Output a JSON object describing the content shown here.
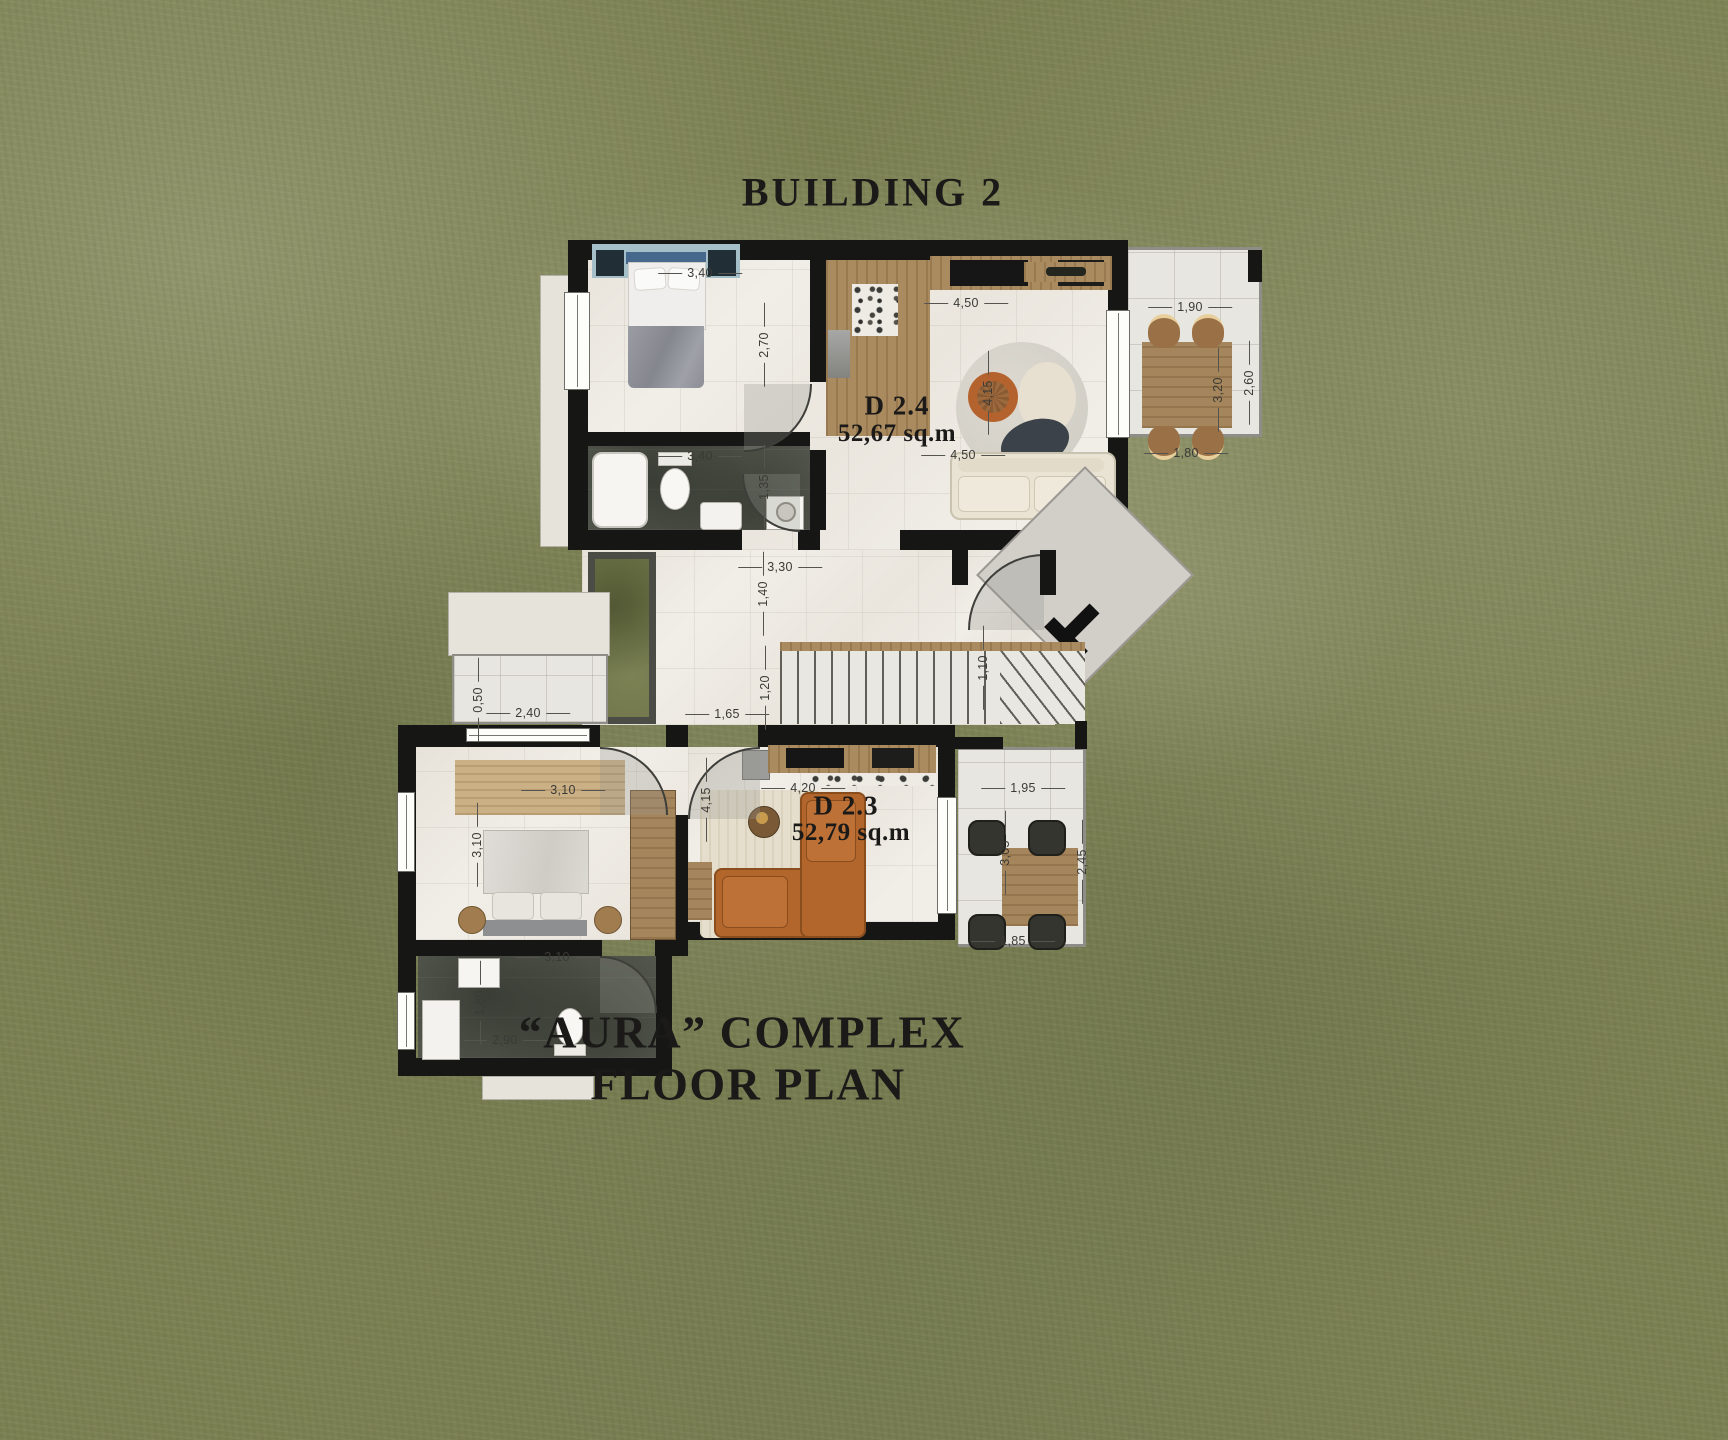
{
  "titles": {
    "building": "BUILDING 2",
    "complex_line1": "“AURA” COMPLEX",
    "complex_line2": "FLOOR PLAN"
  },
  "apartments": [
    {
      "name": "D 2.4",
      "area": "52,67 sq.m"
    },
    {
      "name": "D 2.3",
      "area": "52,79 sq.m"
    }
  ],
  "dimensions": [
    {
      "t": "3,40",
      "x": 700,
      "y": 273,
      "v": 0
    },
    {
      "t": "2,70",
      "x": 764,
      "y": 345,
      "v": 1
    },
    {
      "t": "4,50",
      "x": 966,
      "y": 303,
      "v": 0
    },
    {
      "t": "4,15",
      "x": 988,
      "y": 393,
      "v": 1
    },
    {
      "t": "3,40",
      "x": 700,
      "y": 456,
      "v": 0
    },
    {
      "t": "1,35",
      "x": 764,
      "y": 487,
      "v": 1
    },
    {
      "t": "4,50",
      "x": 963,
      "y": 455,
      "v": 0
    },
    {
      "t": "1,90",
      "x": 1190,
      "y": 307,
      "v": 0
    },
    {
      "t": "3,20",
      "x": 1218,
      "y": 390,
      "v": 1
    },
    {
      "t": "2,60",
      "x": 1249,
      "y": 383,
      "v": 1
    },
    {
      "t": "1,80",
      "x": 1186,
      "y": 453,
      "v": 0
    },
    {
      "t": "3,30",
      "x": 780,
      "y": 567,
      "v": 0
    },
    {
      "t": "1,40",
      "x": 763,
      "y": 594,
      "v": 1
    },
    {
      "t": "1,20",
      "x": 765,
      "y": 688,
      "v": 1
    },
    {
      "t": "1,65",
      "x": 727,
      "y": 714,
      "v": 0
    },
    {
      "t": "1,10",
      "x": 983,
      "y": 668,
      "v": 1
    },
    {
      "t": "0,50",
      "x": 478,
      "y": 700,
      "v": 1
    },
    {
      "t": "2,40",
      "x": 528,
      "y": 713,
      "v": 0
    },
    {
      "t": "3,10",
      "x": 563,
      "y": 790,
      "v": 0
    },
    {
      "t": "3,10",
      "x": 477,
      "y": 845,
      "v": 1
    },
    {
      "t": "4,20",
      "x": 803,
      "y": 788,
      "v": 0
    },
    {
      "t": "4,15",
      "x": 706,
      "y": 800,
      "v": 1
    },
    {
      "t": "3,10",
      "x": 557,
      "y": 957,
      "v": 0
    },
    {
      "t": "1,80",
      "x": 480,
      "y": 1003,
      "v": 1
    },
    {
      "t": "2,90",
      "x": 505,
      "y": 1040,
      "v": 0
    },
    {
      "t": "1,95",
      "x": 1023,
      "y": 788,
      "v": 0
    },
    {
      "t": "3,05",
      "x": 1005,
      "y": 853,
      "v": 1
    },
    {
      "t": "2,45",
      "x": 1082,
      "y": 862,
      "v": 1
    },
    {
      "t": "1,85",
      "x": 1013,
      "y": 941,
      "v": 0
    }
  ],
  "colors": {
    "grass": "#7b8053",
    "wall": "#161614",
    "floor_marble": "#f1eee8",
    "floor_dark_marble": "#565a50",
    "balcony_tile": "#e8e6e0",
    "wood": "#aa8b60",
    "sofa_cream": "#e9e3d4",
    "sofa_cognac": "#b2662c",
    "title_text": "#1b1a18",
    "dimension_text": "#3b3a36"
  }
}
